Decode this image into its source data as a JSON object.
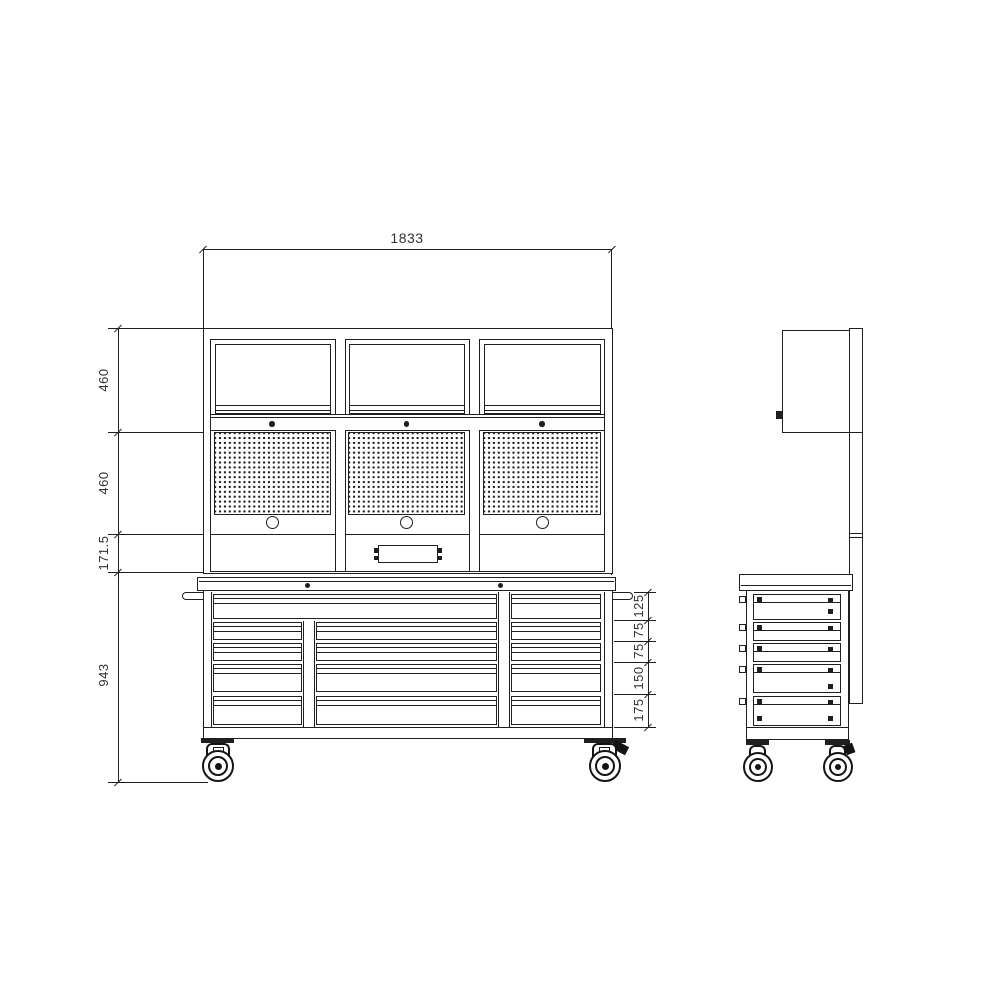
{
  "colors": {
    "line": "#1f1f1f",
    "background": "#ffffff"
  },
  "dimensions": {
    "overall_width": "1833",
    "left_stack": [
      "460",
      "460",
      "171.5",
      "943"
    ],
    "drawer_stack": [
      "125",
      "75",
      "75",
      "150",
      "175"
    ]
  }
}
